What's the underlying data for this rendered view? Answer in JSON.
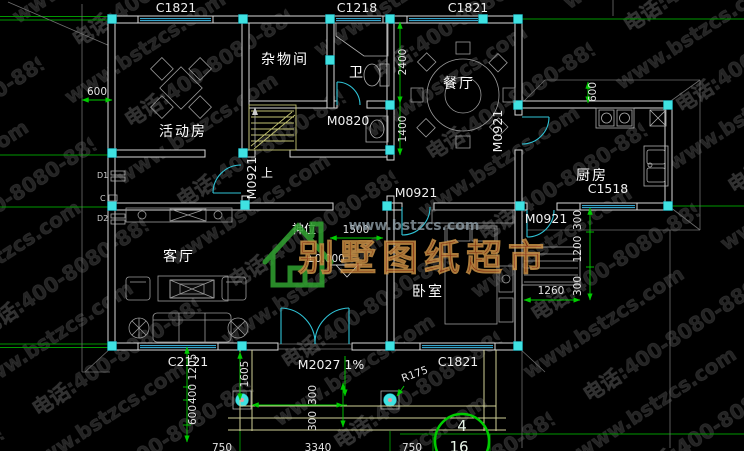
{
  "colors": {
    "background": "#000000",
    "wall": "#d8d8d8",
    "column_cyan": "#3fe2e2",
    "dimension_green": "#00cc00",
    "door_teal": "#2fc3d6",
    "window_blue": "#3dbbe8",
    "label_white": "#ffffff",
    "brand_red": "#a23312",
    "logo_green": "#2f9e2f"
  },
  "watermark": {
    "url": "www.bstzcs.com",
    "phone": "电话:400-8080-889"
  },
  "logo": {
    "site": "www.bstzcs.com",
    "brand": "别墅图纸超市"
  },
  "rooms": {
    "activity": "活动房",
    "storage": "杂物间",
    "bath": "卫",
    "dining": "餐厅",
    "kitchen": "厨房",
    "living": "客厅",
    "bedroom": "卧室",
    "shrine": "神位",
    "stair_up": "上"
  },
  "openings": {
    "c1821": "C1821",
    "c1218": "C1218",
    "c2121": "C2121",
    "c1518": "C1518",
    "m0820": "M0820",
    "m0921": "M0921",
    "m2027": "M2027 1%"
  },
  "dims": {
    "d600": "600",
    "d2400": "2400",
    "d1400": "1400",
    "d1500": "1500",
    "d1260": "1260",
    "d300": "300",
    "d1200": "1200",
    "d1205": "1205",
    "d400": "400",
    "d1605": "1605",
    "d750": "750",
    "d3340": "3340",
    "r175": "R175",
    "level": "±0.000"
  },
  "tags": {
    "t1": "D1",
    "t2": "C",
    "t3": "D2"
  },
  "sheet": {
    "number": "4",
    "total": "16"
  }
}
